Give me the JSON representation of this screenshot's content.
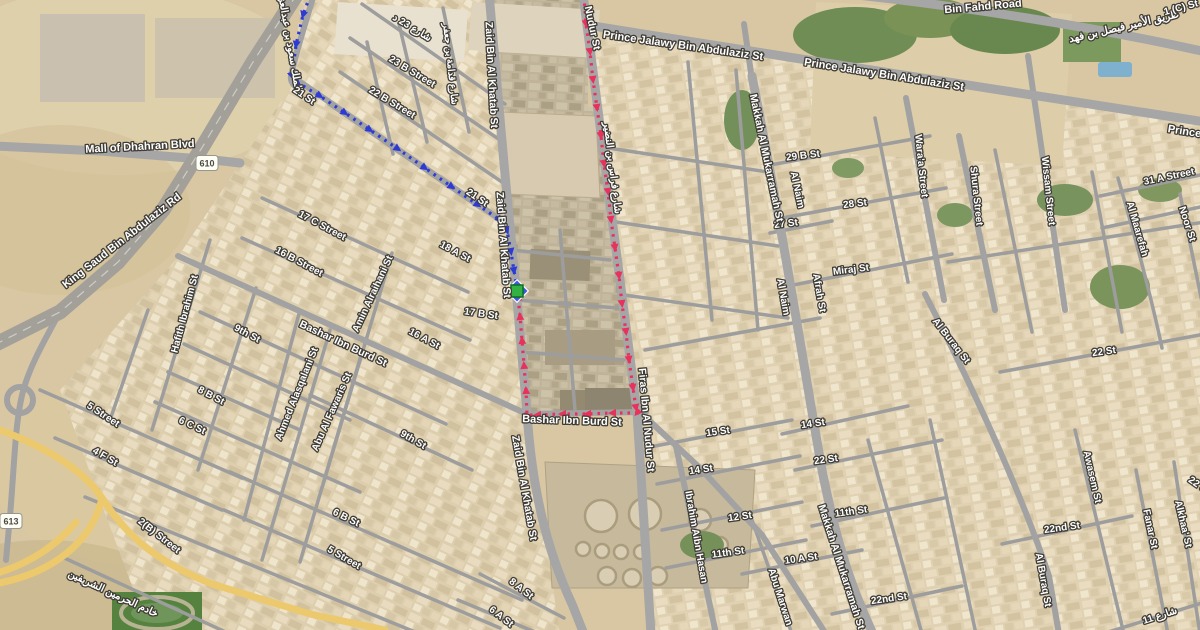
{
  "map": {
    "shields": [
      {
        "label": "610",
        "x": 207,
        "y": 163
      },
      {
        "label": "613",
        "x": 11,
        "y": 521
      }
    ],
    "marker": {
      "name": "destination",
      "x": 517,
      "y": 291,
      "diamond_color": "#3e5adf",
      "square_color": "#33b243",
      "square_border": "#0d6e24"
    },
    "routes": [
      {
        "id": "route-red",
        "color": "#e8315b",
        "points": [
          [
            584,
            -4
          ],
          [
            586,
            24
          ],
          [
            590,
            52
          ],
          [
            593,
            80
          ],
          [
            597,
            108
          ],
          [
            601,
            136
          ],
          [
            604,
            164
          ],
          [
            608,
            192
          ],
          [
            611,
            220
          ],
          [
            615,
            248
          ],
          [
            619,
            276
          ],
          [
            622,
            304
          ],
          [
            626,
            332
          ],
          [
            629,
            360
          ],
          [
            633,
            388
          ],
          [
            636,
            408
          ],
          [
            637,
            413
          ],
          [
            612,
            413
          ],
          [
            587,
            414
          ],
          [
            562,
            414
          ],
          [
            537,
            415
          ],
          [
            527,
            415
          ],
          [
            526,
            390
          ],
          [
            524,
            365
          ],
          [
            522,
            340
          ],
          [
            520,
            316
          ],
          [
            518,
            297
          ],
          [
            517,
            291
          ]
        ]
      },
      {
        "id": "route-blue",
        "color": "#2e3bd3",
        "points": [
          [
            310,
            -4
          ],
          [
            303,
            15
          ],
          [
            296,
            45
          ],
          [
            292,
            76
          ],
          [
            298,
            83
          ],
          [
            320,
            96
          ],
          [
            345,
            113
          ],
          [
            370,
            130
          ],
          [
            398,
            149
          ],
          [
            425,
            168
          ],
          [
            452,
            187
          ],
          [
            478,
            205
          ],
          [
            500,
            220
          ],
          [
            507,
            231
          ],
          [
            511,
            252
          ],
          [
            514,
            271
          ],
          [
            517,
            287
          ]
        ]
      }
    ],
    "labels": [
      {
        "text": "Mall of Dhahran Blvd",
        "x": 140,
        "y": 147,
        "rot": -3,
        "size": 11
      },
      {
        "text": "King Saud Bin Abdulaziz Rd",
        "x": 122,
        "y": 241,
        "rot": -38,
        "size": 11
      },
      {
        "text": "الملك سعود بن عبدالعزيز",
        "x": 289,
        "y": 40,
        "rot": 80,
        "size": 10
      },
      {
        "text": "21 St",
        "x": 304,
        "y": 96,
        "rot": 34,
        "size": 10
      },
      {
        "text": "21 St",
        "x": 477,
        "y": 198,
        "rot": 34,
        "size": 10
      },
      {
        "text": "شارع 23 د",
        "x": 412,
        "y": 28,
        "rot": 31,
        "size": 10
      },
      {
        "text": "23 B Street",
        "x": 412,
        "y": 72,
        "rot": 31,
        "size": 10
      },
      {
        "text": "22 B Street",
        "x": 392,
        "y": 103,
        "rot": 31,
        "size": 10
      },
      {
        "text": "شارع قدامة بن جعفر",
        "x": 450,
        "y": 64,
        "rot": 84,
        "size": 9.5
      },
      {
        "text": "Zaid Bin Al Khatab St",
        "x": 491,
        "y": 75,
        "rot": 87,
        "size": 10.5
      },
      {
        "text": "Zaid Bin Al Khatab St",
        "x": 503,
        "y": 245,
        "rot": 86,
        "size": 10.5
      },
      {
        "text": "Zaid Bin Al Khatab St",
        "x": 524,
        "y": 488,
        "rot": 80,
        "size": 10.5
      },
      {
        "text": "Nudur St",
        "x": 592,
        "y": 28,
        "rot": 78,
        "size": 10.5
      },
      {
        "text": "شارع فراس بن النضير",
        "x": 612,
        "y": 168,
        "rot": 83,
        "size": 10
      },
      {
        "text": "Prince Jalawy Bin Abdulaziz St",
        "x": 683,
        "y": 46,
        "rot": 8,
        "size": 11
      },
      {
        "text": "Prince Jalawy Bin Abdulaziz St",
        "x": 884,
        "y": 75,
        "rot": 9,
        "size": 11
      },
      {
        "text": "Bin Fahd Road",
        "x": 983,
        "y": 7,
        "rot": -5,
        "size": 11
      },
      {
        "text": "طريق الأمير فيصل بن فهد",
        "x": 1124,
        "y": 27,
        "rot": -13,
        "size": 10.5
      },
      {
        "text": "1 (C) St",
        "x": 1181,
        "y": 8,
        "rot": -15,
        "size": 10
      },
      {
        "text": "Prince Ja",
        "x": 1192,
        "y": 133,
        "rot": 9,
        "size": 11
      },
      {
        "text": "29 B St",
        "x": 803,
        "y": 156,
        "rot": -7,
        "size": 10
      },
      {
        "text": "28 St",
        "x": 855,
        "y": 204,
        "rot": -7,
        "size": 10
      },
      {
        "text": "27 St",
        "x": 786,
        "y": 224,
        "rot": -7,
        "size": 10
      },
      {
        "text": "Al Naim",
        "x": 797,
        "y": 190,
        "rot": 78,
        "size": 10
      },
      {
        "text": "Al Naim",
        "x": 783,
        "y": 297,
        "rot": 80,
        "size": 10
      },
      {
        "text": "Afrah St",
        "x": 819,
        "y": 293,
        "rot": 80,
        "size": 10
      },
      {
        "text": "Miraj St",
        "x": 851,
        "y": 270,
        "rot": -7,
        "size": 10
      },
      {
        "text": "Makkah Al Mukarramah St",
        "x": 766,
        "y": 158,
        "rot": 78,
        "size": 10.5
      },
      {
        "text": "Makkah Al Mukarramah St",
        "x": 841,
        "y": 567,
        "rot": 72,
        "size": 10.5
      },
      {
        "text": "Wara'a Street",
        "x": 921,
        "y": 166,
        "rot": 84,
        "size": 10
      },
      {
        "text": "Shura Street",
        "x": 976,
        "y": 196,
        "rot": 84,
        "size": 10
      },
      {
        "text": "Wissam Street",
        "x": 1048,
        "y": 191,
        "rot": 84,
        "size": 10
      },
      {
        "text": "31 A Street",
        "x": 1169,
        "y": 177,
        "rot": -12,
        "size": 10
      },
      {
        "text": "Al Maarefah",
        "x": 1137,
        "y": 229,
        "rot": 74,
        "size": 10
      },
      {
        "text": "Noor St",
        "x": 1187,
        "y": 224,
        "rot": 72,
        "size": 10
      },
      {
        "text": "22 St",
        "x": 1104,
        "y": 352,
        "rot": -8,
        "size": 10
      },
      {
        "text": "Awasem St",
        "x": 1092,
        "y": 477,
        "rot": 77,
        "size": 10
      },
      {
        "text": "Fanar St",
        "x": 1150,
        "y": 529,
        "rot": 78,
        "size": 10
      },
      {
        "text": "Alkhaa' St",
        "x": 1183,
        "y": 524,
        "rot": 77,
        "size": 10
      },
      {
        "text": "22 St",
        "x": 1199,
        "y": 486,
        "rot": 35,
        "size": 10
      },
      {
        "text": "22nd St",
        "x": 1062,
        "y": 528,
        "rot": -8,
        "size": 10
      },
      {
        "text": "22nd St",
        "x": 889,
        "y": 599,
        "rot": -8,
        "size": 10
      },
      {
        "text": "شارع 11",
        "x": 1160,
        "y": 616,
        "rot": -18,
        "size": 10
      },
      {
        "text": "Al Buraq St",
        "x": 951,
        "y": 341,
        "rot": 52,
        "size": 10
      },
      {
        "text": "Al Buraq St",
        "x": 1043,
        "y": 580,
        "rot": 80,
        "size": 10
      },
      {
        "text": "14 St",
        "x": 813,
        "y": 424,
        "rot": -8,
        "size": 10
      },
      {
        "text": "22 St",
        "x": 826,
        "y": 460,
        "rot": -8,
        "size": 10
      },
      {
        "text": "15 St",
        "x": 718,
        "y": 432,
        "rot": -8,
        "size": 10
      },
      {
        "text": "14 St",
        "x": 701,
        "y": 470,
        "rot": -8,
        "size": 10
      },
      {
        "text": "12 St",
        "x": 740,
        "y": 517,
        "rot": -8,
        "size": 10
      },
      {
        "text": "11th St",
        "x": 728,
        "y": 553,
        "rot": -8,
        "size": 10
      },
      {
        "text": "11th St",
        "x": 851,
        "y": 512,
        "rot": -8,
        "size": 10
      },
      {
        "text": "10 A St",
        "x": 801,
        "y": 559,
        "rot": -8,
        "size": 10
      },
      {
        "text": "Ibrahim Aibn Hasan",
        "x": 696,
        "y": 537,
        "rot": 80,
        "size": 10
      },
      {
        "text": "Abu Marwan",
        "x": 780,
        "y": 597,
        "rot": 72,
        "size": 10
      },
      {
        "text": "Firas Ibn Al Nudur St",
        "x": 646,
        "y": 420,
        "rot": 85,
        "size": 10.5
      },
      {
        "text": "Bashar Ibn Burd St",
        "x": 572,
        "y": 421,
        "rot": 2,
        "size": 11
      },
      {
        "text": "Bashar Ibn Burd St",
        "x": 343,
        "y": 344,
        "rot": 25,
        "size": 10.5
      },
      {
        "text": "Amin Alraihani St",
        "x": 373,
        "y": 294,
        "rot": -65,
        "size": 10
      },
      {
        "text": "16 A St",
        "x": 424,
        "y": 339,
        "rot": 28,
        "size": 10
      },
      {
        "text": "18 A St",
        "x": 455,
        "y": 252,
        "rot": 28,
        "size": 10
      },
      {
        "text": "17 C Street",
        "x": 322,
        "y": 226,
        "rot": 28,
        "size": 10
      },
      {
        "text": "16 B Street",
        "x": 299,
        "y": 262,
        "rot": 28,
        "size": 10
      },
      {
        "text": "17 B St",
        "x": 481,
        "y": 314,
        "rot": 8,
        "size": 10
      },
      {
        "text": "9th St",
        "x": 247,
        "y": 334,
        "rot": 28,
        "size": 10
      },
      {
        "text": "9th St",
        "x": 413,
        "y": 440,
        "rot": 30,
        "size": 10
      },
      {
        "text": "Hafith Ibrahim St",
        "x": 185,
        "y": 314,
        "rot": -75,
        "size": 10
      },
      {
        "text": "8 B St",
        "x": 211,
        "y": 396,
        "rot": 28,
        "size": 10
      },
      {
        "text": "6 C St",
        "x": 192,
        "y": 426,
        "rot": 25,
        "size": 10
      },
      {
        "text": "5 Street",
        "x": 103,
        "y": 415,
        "rot": 33,
        "size": 10
      },
      {
        "text": "4 F St",
        "x": 105,
        "y": 457,
        "rot": 30,
        "size": 10
      },
      {
        "text": "2(B) Street",
        "x": 159,
        "y": 536,
        "rot": 38,
        "size": 10
      },
      {
        "text": "6 B St",
        "x": 346,
        "y": 518,
        "rot": 26,
        "size": 10
      },
      {
        "text": "5 Street",
        "x": 344,
        "y": 558,
        "rot": 30,
        "size": 10
      },
      {
        "text": "8 A St",
        "x": 521,
        "y": 589,
        "rot": 38,
        "size": 10
      },
      {
        "text": "6 A St",
        "x": 501,
        "y": 617,
        "rot": 38,
        "size": 10
      },
      {
        "text": "Ahmed Alasqalani St",
        "x": 297,
        "y": 394,
        "rot": -68,
        "size": 10
      },
      {
        "text": "Abu Al Fawaris St",
        "x": 332,
        "y": 412,
        "rot": -66,
        "size": 10
      },
      {
        "text": "خادم الحرمين الشريفين",
        "x": 113,
        "y": 594,
        "rot": 25,
        "size": 10
      }
    ]
  }
}
